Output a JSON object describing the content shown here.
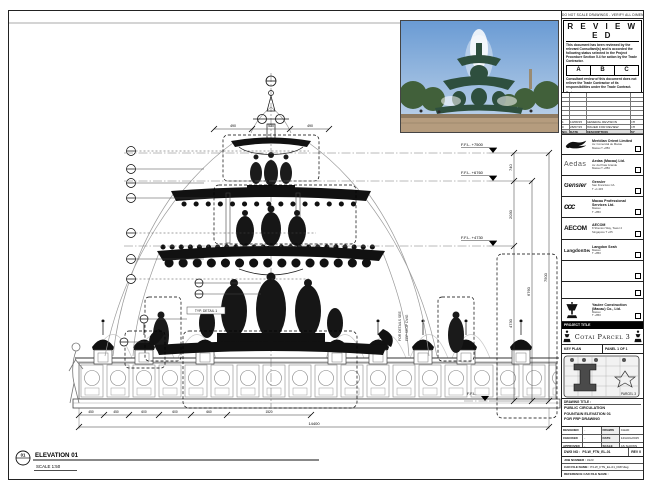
{
  "stamp": {
    "strip_text": "DO NOT SCALE DRAWINGS - VERIFY ALL DIMENSIONS ON SITE",
    "title": "R E V I E W E D",
    "body1": "This document has been reviewed by the relevant Consultant(s) and is accorded the following status selected in the Project Procedure Section 5.4 for action by the Trade Contractor.",
    "statuses": [
      "A",
      "B",
      "C"
    ],
    "body2": "Consultant review of this document does not relieve the Trade Contractor of its responsibilities under the Trade Contract.",
    "date_label": "Date :"
  },
  "revision": {
    "rows": [
      {
        "no": "",
        "date": "",
        "desc": "",
        "by": ""
      },
      {
        "no": "",
        "date": "",
        "desc": "",
        "by": ""
      },
      {
        "no": "",
        "date": "",
        "desc": "",
        "by": ""
      },
      {
        "no": "",
        "date": "",
        "desc": "",
        "by": ""
      },
      {
        "no": "",
        "date": "",
        "desc": "",
        "by": ""
      },
      {
        "no": "",
        "date": "",
        "desc": "",
        "by": ""
      },
      {
        "no": "1",
        "date": "10/08/15",
        "desc": "GENERAL REVISION",
        "by": "CH"
      },
      {
        "no": "0",
        "date": "28/07/15",
        "desc": "ISSUED FOR REVIEW",
        "by": "CH"
      }
    ],
    "header": {
      "no": "NO.",
      "date": "DATE",
      "desc": "DESCRIPTION",
      "by": "BY"
    }
  },
  "consultants": [
    {
      "logo_text": "",
      "name": "Meridian Orient Limited",
      "addr1": "Av. Comercial de Macau",
      "addr2": "Macau  T +853"
    },
    {
      "logo_text": "Aedas",
      "name": "Aedas (Macau) Ltd.",
      "addr1": "Av. da Praia Grande",
      "addr2": "Macau  T +853"
    },
    {
      "logo_text": "Gensler",
      "name": "Gensler",
      "addr1": "San Francisco CA",
      "addr2": "T +1 415"
    },
    {
      "logo_text": "ccc",
      "name": "Macau Professional Services Ltd.",
      "addr1": "Macau",
      "addr2": "T +853"
    },
    {
      "logo_text": "AECOM",
      "name": "AECOM",
      "addr1": "8 Shenton Way, Tower 2",
      "addr2": "Singapore  T +65"
    },
    {
      "logo_text": "LangdonSeah",
      "name": "Langdon Seah",
      "addr1": "Macau",
      "addr2": "T +853"
    },
    {
      "logo_text": "",
      "name": "",
      "addr1": "",
      "addr2": ""
    },
    {
      "logo_text": "",
      "name": "",
      "addr1": "",
      "addr2": ""
    },
    {
      "logo_text": "",
      "name": "Yaulee Construction (Macau) Co., Ltd.",
      "addr1": "Macau",
      "addr2": "T +853"
    }
  ],
  "project": {
    "label": "PROJECT TITLE",
    "title": "Cotai Parcel 3"
  },
  "key_plan": {
    "label": "KEY PLAN",
    "panel": "PANEL 1 OF 1",
    "tag": "PARCEL 3"
  },
  "title_block": {
    "drawing_title_label": "DRAWING TITLE :",
    "line1": "PUBLIC CIRCULATION",
    "line2": "FOUNTAIN ELEVATION 01",
    "line3": "FOR FRP DRAWING",
    "credits": [
      {
        "k1": "DESIGNED",
        "v1": "-",
        "k2": "DRAWN",
        "v2": "CHAD"
      },
      {
        "k1": "CHECKED",
        "v1": "-",
        "k2": "DATE",
        "v2": "12/AUG/2015"
      },
      {
        "k1": "APPROVED",
        "v1": "-",
        "k2": "SCALE",
        "v2": "AS SHOWN"
      }
    ],
    "dwg_no_label": "DWG NO :",
    "dwg_no": "P3-W_FTN_EL-01",
    "rev": "REV 0",
    "job_label": "JOB NUMBER :",
    "job": "3123",
    "cad_label": "CAD FILE NAME :",
    "cad": "P3-W_FTN_EL-01_FRP.dwg",
    "ref_label": "REFERENCE CAD FILE NAME :"
  },
  "drawing": {
    "elevation": {
      "number": "01",
      "title": "ELEVATION 01",
      "scale": "SCALE  1:50"
    },
    "levels": [
      "F.F.L. +7500",
      "F.F.L. +6760",
      "F.F.L. +4730",
      "F.F.L."
    ],
    "vdims": [
      "740",
      "2030",
      "4730",
      "6760",
      "7500"
    ],
    "top_dims": [
      "490",
      "530",
      "490"
    ],
    "bottom_dims": [
      "450",
      "450",
      "600",
      "600",
      "660",
      "1520"
    ],
    "overall_dim": "14400",
    "detail_tag": "TYP. DETAIL 1",
    "side_note_1": "FOR DETAILS SEE",
    "side_note_2": "FRP SHOP DWG"
  }
}
